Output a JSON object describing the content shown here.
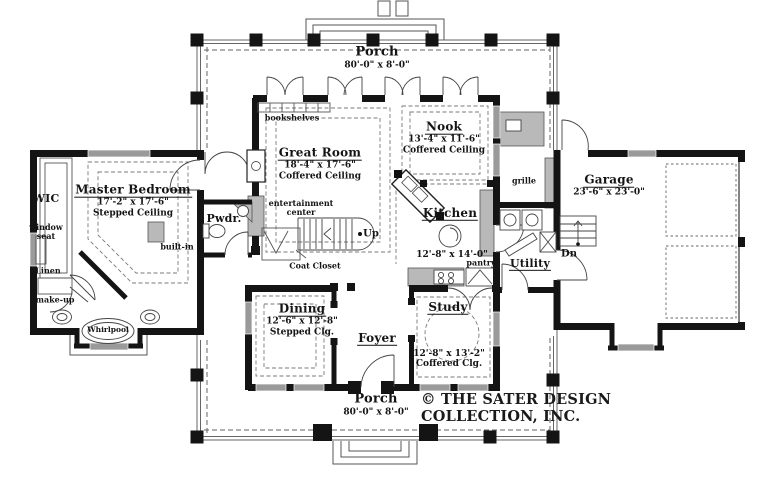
{
  "copyright": {
    "line1": "© THE SATER DESIGN",
    "line2": "COLLECTION, INC."
  },
  "rooms": {
    "porch_top": {
      "name": "Porch",
      "dims": "80'-0\" x 8'-0\""
    },
    "porch_bottom": {
      "name": "Porch",
      "dims": "80'-0\" x 8'-0\""
    },
    "great_room": {
      "name": "Great Room",
      "dims": "18'-4\" x 17'-6\"",
      "ceiling": "Coffered Ceiling"
    },
    "nook": {
      "name": "Nook",
      "dims": "13'-4\" x 11'-6\"",
      "ceiling": "Coffered Ceiling"
    },
    "kitchen": {
      "name": "Kitchen",
      "dims": "12'-8\" x 14'-0\""
    },
    "master_bedroom": {
      "name": "Master Bedroom",
      "dims": "17'-2\" x 17'-6\"",
      "ceiling": "Stepped Ceiling"
    },
    "garage": {
      "name": "Garage",
      "dims": "23'-6\" x 23'-0\""
    },
    "utility": {
      "name": "Utility"
    },
    "dining": {
      "name": "Dining",
      "dims": "12'-6\" x 12'-8\"",
      "ceiling": "Stepped Clg."
    },
    "study": {
      "name": "Study",
      "dims": "12'-8\" x 13'-2\"",
      "ceiling": "Coffered Clg."
    },
    "foyer": {
      "name": "Foyer"
    },
    "pwdr": {
      "name": "Pwdr."
    },
    "wic": {
      "name": "WIC"
    }
  },
  "annotations": {
    "bookshelves": "bookshelves",
    "entertainment_1": "entertainment",
    "entertainment_2": "center",
    "built_in": "built-in",
    "coat_closet": "Coat Closet",
    "up": "Up",
    "dn": "Dn",
    "window_seat_1": "window",
    "window_seat_2": "seat",
    "linen": "Linen",
    "make_up": "make-up",
    "whirlpool": "Whirlpool",
    "grille": "grille",
    "pantry": "pantry"
  },
  "colors": {
    "wall": "#141414",
    "window": "#9a9a9a",
    "dash": "#777777"
  }
}
